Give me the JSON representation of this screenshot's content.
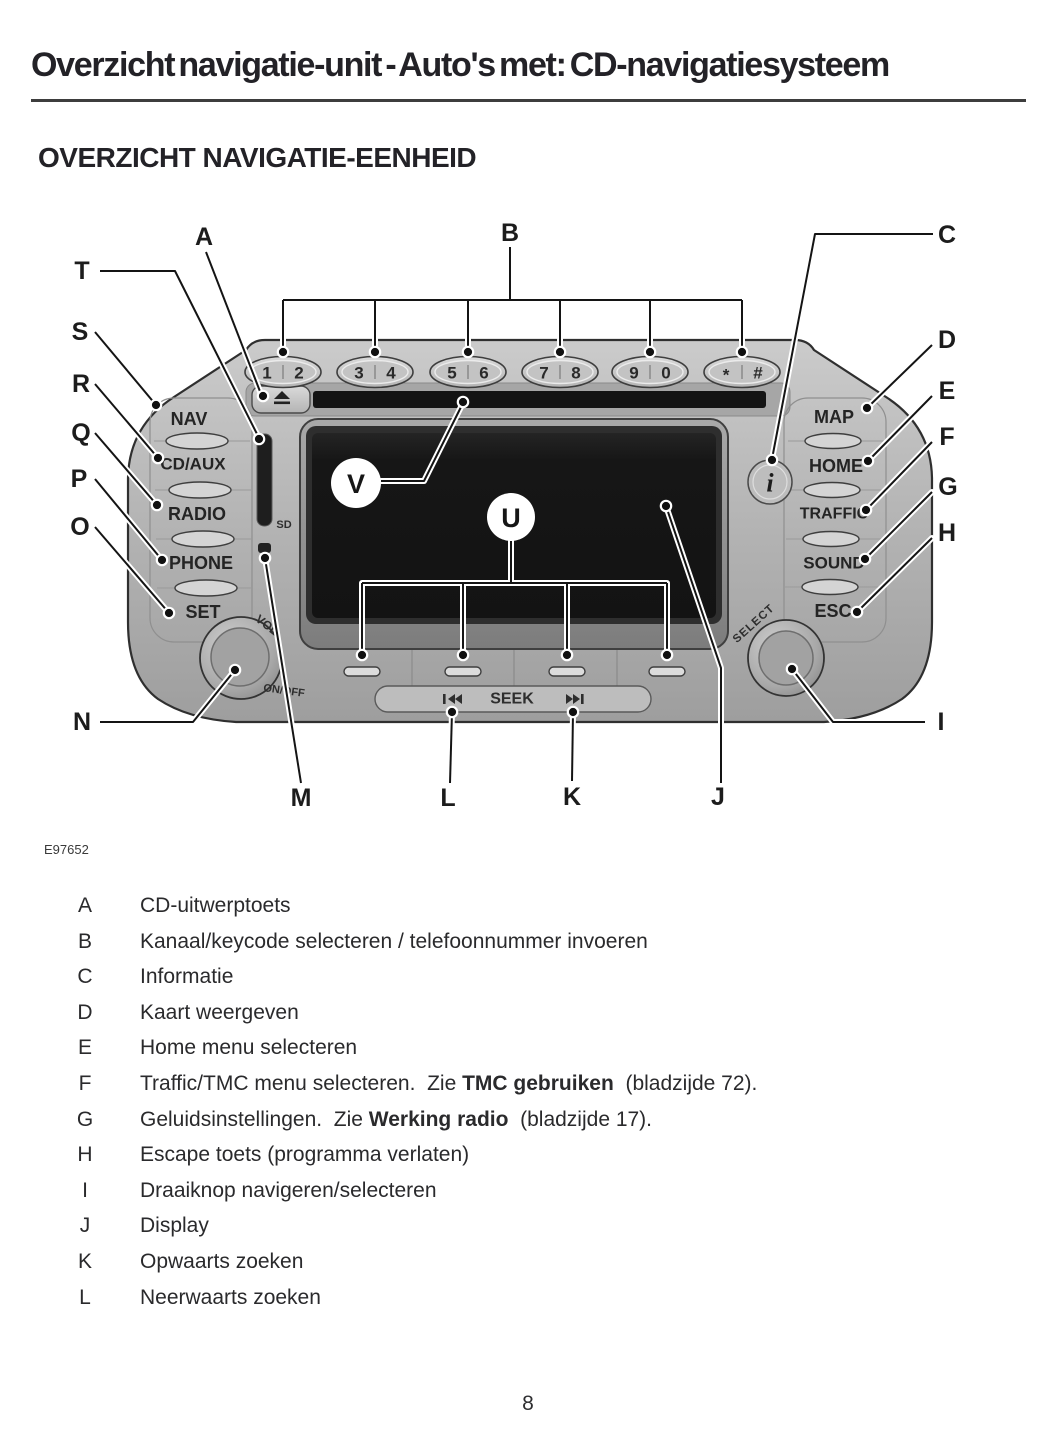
{
  "page": {
    "title": "Overzicht navigatie-unit - Auto's met: CD-navigatiesysteem",
    "section_heading": "OVERZICHT NAVIGATIE-EENHEID",
    "figure_code": "E97652",
    "page_number": "8"
  },
  "colors": {
    "heading_ink": "#232227",
    "body_ink": "#2a2a2c"
  },
  "diagram": {
    "letters": {
      "A": "A",
      "B": "B",
      "C": "C",
      "D": "D",
      "E": "E",
      "F": "F",
      "G": "G",
      "H": "H",
      "I": "I",
      "J": "J",
      "K": "K",
      "L": "L",
      "M": "M",
      "N": "N",
      "O": "O",
      "P": "P",
      "Q": "Q",
      "R": "R",
      "S": "S",
      "T": "T",
      "U": "U",
      "V": "V"
    },
    "keys": [
      [
        "1",
        "2"
      ],
      [
        "3",
        "4"
      ],
      [
        "5",
        "6"
      ],
      [
        "7",
        "8"
      ],
      [
        "9",
        "0"
      ],
      [
        "*",
        "#"
      ]
    ],
    "left_buttons": [
      "NAV",
      "CD/AUX",
      "RADIO",
      "PHONE",
      "SET"
    ],
    "right_buttons": [
      "MAP",
      "HOME",
      "TRAFFIC",
      "SOUND",
      "ESC"
    ],
    "labels": {
      "sd": "SD",
      "vol": "VOL",
      "on_off": "ON/OFF",
      "select": "SELECT",
      "seek": "SEEK",
      "info": "i"
    }
  },
  "legend": {
    "rows": [
      {
        "letter": "A",
        "parts": [
          {
            "t": "CD-uitwerptoets",
            "b": false
          }
        ]
      },
      {
        "letter": "B",
        "parts": [
          {
            "t": "Kanaal/keycode selecteren / telefoonnummer invoeren",
            "b": false
          }
        ]
      },
      {
        "letter": "C",
        "parts": [
          {
            "t": "Informatie",
            "b": false
          }
        ]
      },
      {
        "letter": "D",
        "parts": [
          {
            "t": "Kaart weergeven",
            "b": false
          }
        ]
      },
      {
        "letter": "E",
        "parts": [
          {
            "t": "Home menu selecteren",
            "b": false
          }
        ]
      },
      {
        "letter": "F",
        "parts": [
          {
            "t": "Traffic/TMC menu selecteren.  Zie ",
            "b": false
          },
          {
            "t": "TMC gebruiken",
            "b": true
          },
          {
            "t": "  (bladzijde 72).",
            "b": false
          }
        ]
      },
      {
        "letter": "G",
        "parts": [
          {
            "t": "Geluidsinstellingen.  Zie ",
            "b": false
          },
          {
            "t": "Werking radio",
            "b": true
          },
          {
            "t": "  (bladzijde 17).",
            "b": false
          }
        ]
      },
      {
        "letter": "H",
        "parts": [
          {
            "t": "Escape toets (programma verlaten)",
            "b": false
          }
        ]
      },
      {
        "letter": "I",
        "parts": [
          {
            "t": "Draaiknop navigeren/selecteren",
            "b": false
          }
        ]
      },
      {
        "letter": "J",
        "parts": [
          {
            "t": "Display",
            "b": false
          }
        ]
      },
      {
        "letter": "K",
        "parts": [
          {
            "t": "Opwaarts zoeken",
            "b": false
          }
        ]
      },
      {
        "letter": "L",
        "parts": [
          {
            "t": "Neerwaarts zoeken",
            "b": false
          }
        ]
      }
    ]
  }
}
